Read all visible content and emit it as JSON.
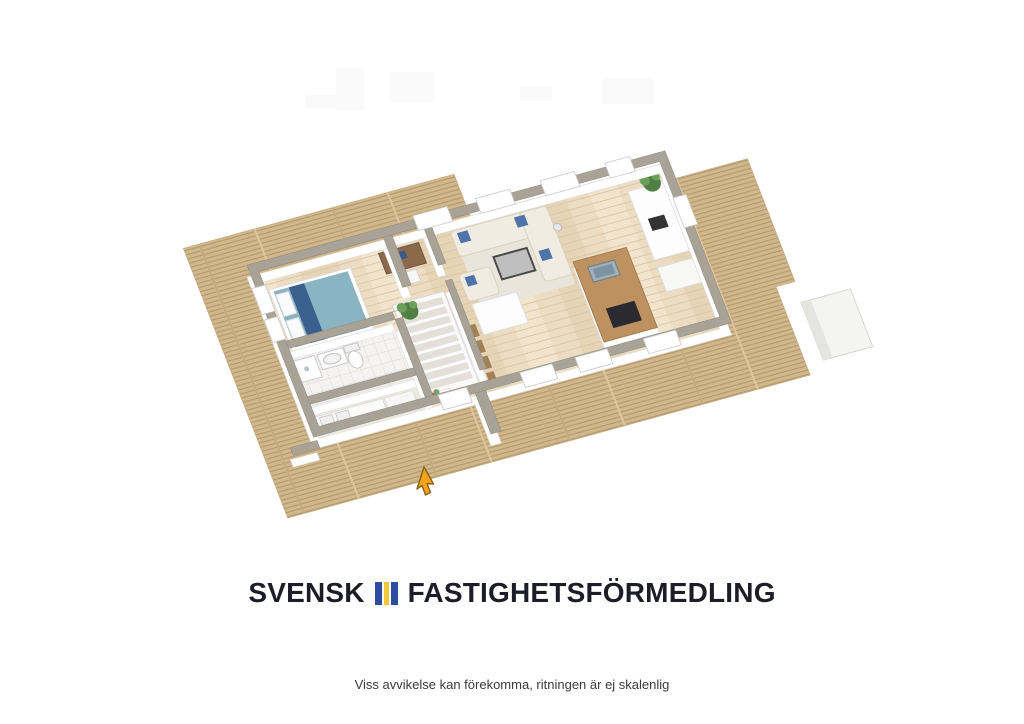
{
  "brand": {
    "name_left": "SVENSK",
    "name_right": "FASTIGHETSFÖRMEDLING",
    "icon": "brand-flag-icon",
    "icon_colors": {
      "blue": "#2d4e9e",
      "yellow": "#f3c735"
    },
    "text_color": "#1d1d27"
  },
  "footer": {
    "disclaimer": "Viss avvikelse kan förekomma, ritningen är ej skalenlig"
  },
  "floorplan": {
    "view": "3D isometric floor plan",
    "colors": {
      "deck_wood": "#d2b78c",
      "deck_plank_line": "#b1976d",
      "interior_floor": "#ecdcc1",
      "interior_plank_line": "#ddc8a8",
      "wall_face": "#ffffff",
      "wall_cap": "#a9a296",
      "kitchen_island_top": "#bd9260",
      "bed_cover": "#8ab4c2",
      "sofa": "#f1ece1",
      "pillow_accent": "#4f74ab",
      "plant_green": "#5c8f4d",
      "flower_red": "#d4405a",
      "cursor_yellow": "#f6a41f"
    }
  }
}
